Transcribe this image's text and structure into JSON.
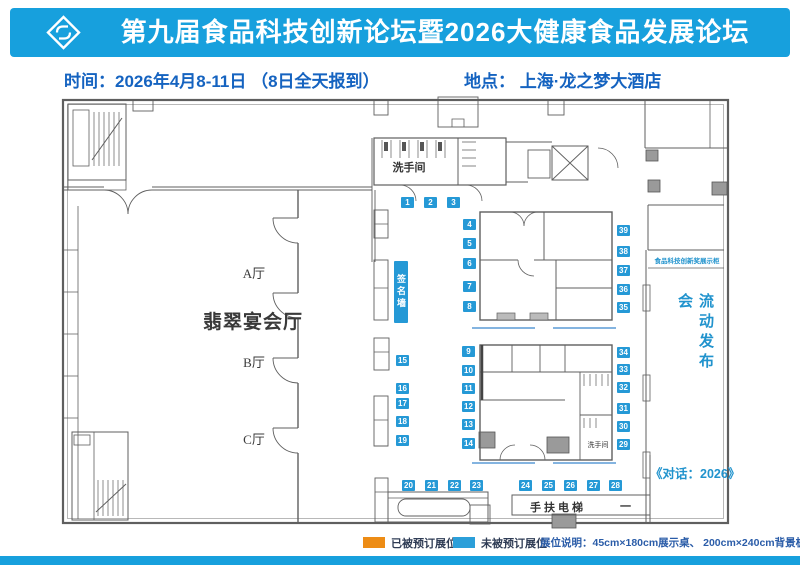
{
  "header": {
    "title": "第九届食品科技创新论坛暨2026大健康食品发展论坛",
    "logo": "brand-diamond-icon"
  },
  "info": {
    "time": "时间：2026年4月8-11日 （8日全天报到）",
    "venue": "地点： 上海·龙之梦大酒店"
  },
  "plan": {
    "halls": {
      "banquet": "翡翠宴会厅",
      "a": "A厅",
      "b": "B厅",
      "c": "C厅"
    },
    "labels": {
      "restroom_top": "洗手间",
      "restroom_inner": "洗手间",
      "signature_wall": "签名墙",
      "award_display": "食品科技创新奖展示柜",
      "mobile_launch": "流动发布会",
      "dialogue": "《对话：2026》",
      "escalator": "手扶电梯",
      "escalator_dash": "一"
    },
    "booth_labels": [
      "1",
      "2",
      "3",
      "4",
      "5",
      "6",
      "7",
      "8",
      "9",
      "10",
      "11",
      "12",
      "13",
      "14",
      "15",
      "16",
      "17",
      "18",
      "19",
      "20",
      "21",
      "22",
      "23",
      "24",
      "25",
      "26",
      "27",
      "28",
      "29",
      "30",
      "31",
      "32",
      "33",
      "34",
      "35",
      "36",
      "37",
      "38",
      "39"
    ]
  },
  "legend": {
    "booked": "已被预订展位",
    "available": "未被预订展位",
    "note": "展位说明：45cm×180cm展示桌、 200cm×240cm背景板",
    "booked_color": "#ED8C15",
    "available_color": "#2B9FD9"
  },
  "colors": {
    "header_bg": "#17A0DD",
    "booth_blue": "#2599D6",
    "info_text": "#1563C0",
    "plan_text_blue": "#2193CD"
  }
}
